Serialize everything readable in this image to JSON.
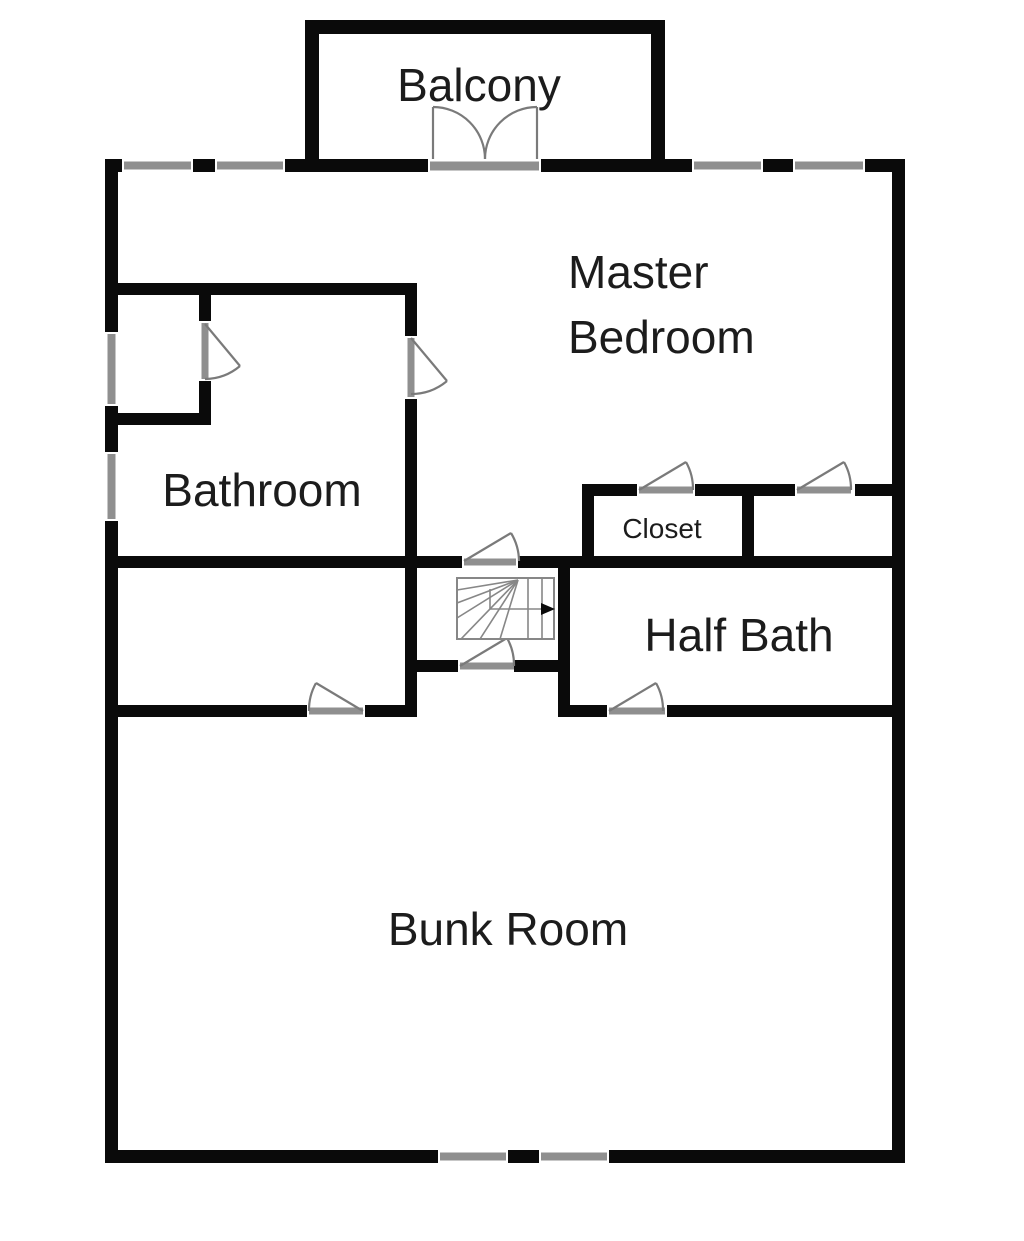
{
  "colors": {
    "wall": "#0a0a0a",
    "window": "#8f8f8f",
    "door": "#7a7a7a",
    "stairs": "#878787",
    "text": "#1c1c1c",
    "background": "#ffffff"
  },
  "rooms": {
    "balcony": {
      "label": "Balcony"
    },
    "master_bedroom": {
      "label": "Master Bedroom",
      "line1": "Master",
      "line2": "Bedroom"
    },
    "bathroom": {
      "label": "Bathroom"
    },
    "closet": {
      "label": "Closet"
    },
    "half_bath": {
      "label": "Half Bath"
    },
    "bunk_room": {
      "label": "Bunk Room"
    }
  }
}
